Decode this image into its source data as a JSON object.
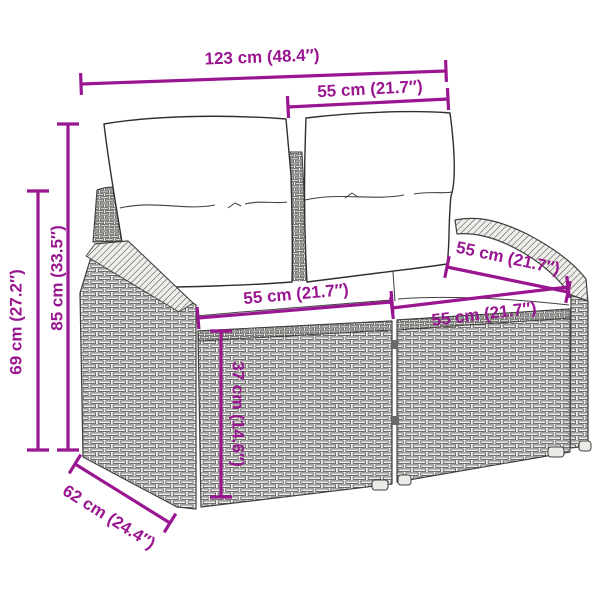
{
  "colors": {
    "accent": "#9A1691",
    "artwork_stroke": "#3F3F3F",
    "background": "#FFFFFF"
  },
  "dimensions": [
    {
      "id": "overall-width",
      "label": "123 cm (48.4″)"
    },
    {
      "id": "backrest-width",
      "label": "55 cm (21.7″)"
    },
    {
      "id": "height-overall",
      "label": "85 cm (33.5″)"
    },
    {
      "id": "height-armrest",
      "label": "69 cm (27.2″)"
    },
    {
      "id": "seat-width-left",
      "label": "55 cm (21.7″)"
    },
    {
      "id": "seat-depth-armrest",
      "label": "55 cm (21.7″)"
    },
    {
      "id": "seat-width-right",
      "label": "55 cm (21.7″)"
    },
    {
      "id": "base-height",
      "label": "37 cm (14.6″)"
    },
    {
      "id": "depth-overall",
      "label": "62 cm (24.4″)"
    }
  ]
}
